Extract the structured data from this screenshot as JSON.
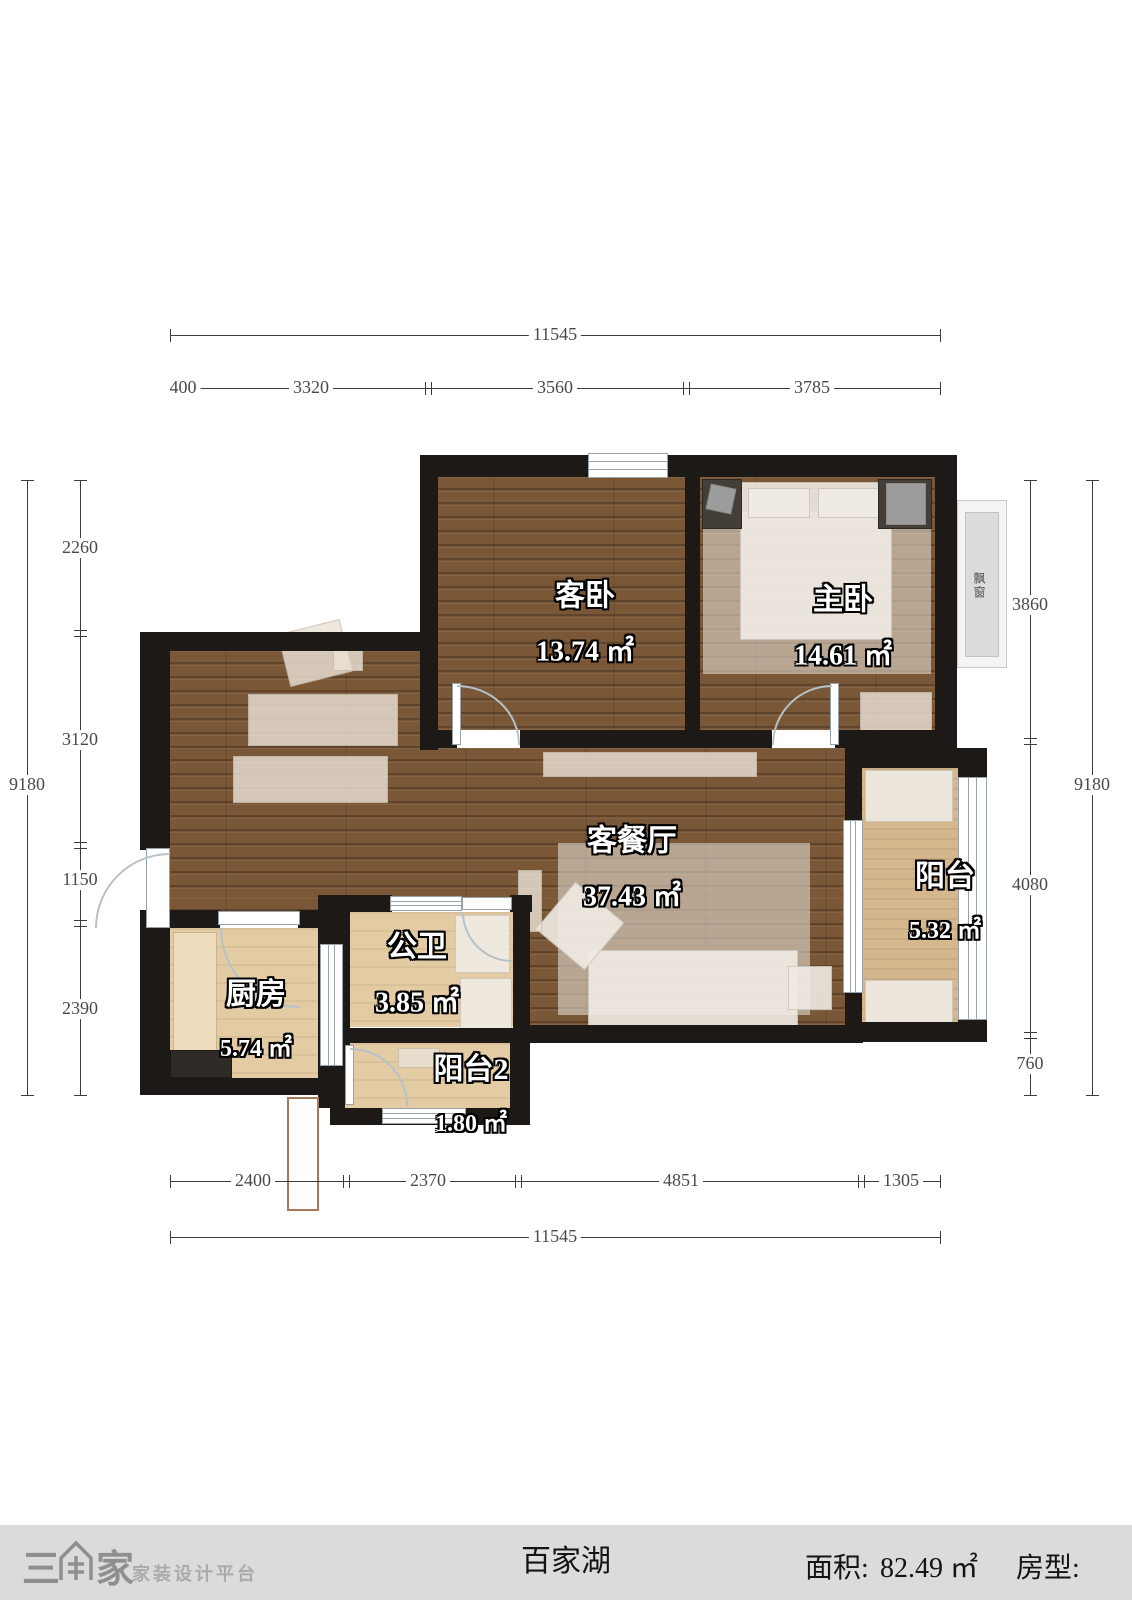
{
  "plan": {
    "rooms": [
      {
        "name": "客卧",
        "area": "13.74 ㎡"
      },
      {
        "name": "主卧",
        "area": "14.61 ㎡"
      },
      {
        "name": "客餐厅",
        "area": "37.43 ㎡"
      },
      {
        "name": "阳台",
        "area": "5.32 ㎡"
      },
      {
        "name": "公卫",
        "area": "3.85 ㎡"
      },
      {
        "name": "厨房",
        "area": "5.74 ㎡"
      },
      {
        "name": "阳台2",
        "area": "1.80 ㎡"
      }
    ],
    "bay_window_label": "飘窗"
  },
  "dims": {
    "top": {
      "total": "11545",
      "segments": [
        "400",
        "3320",
        "3560",
        "3785"
      ]
    },
    "bottom": {
      "total": "11545",
      "segments": [
        "2400",
        "2370",
        "4851",
        "1305"
      ]
    },
    "left": {
      "total": "9180",
      "segments": [
        "2260",
        "3120",
        "1150",
        "2390"
      ]
    },
    "right": {
      "total": "9180",
      "segments": [
        "3860",
        "4080",
        "760"
      ]
    }
  },
  "footer": {
    "logo_text": "三维家",
    "logo_prefix": "三",
    "logo_suffix": "家",
    "tagline": "家装设计平台",
    "project_name": "百家湖",
    "area_label": "面积:",
    "area_value": "82.49 ㎡",
    "type_label": "房型:"
  },
  "colors": {
    "wall": "#1d1916",
    "wood_floor": "#7a5737",
    "tile_floor": "#e3cba4",
    "balcony_floor": "#d4b78c",
    "footer_bg": "#dbdbdb",
    "flue_border": "#a5795b"
  }
}
